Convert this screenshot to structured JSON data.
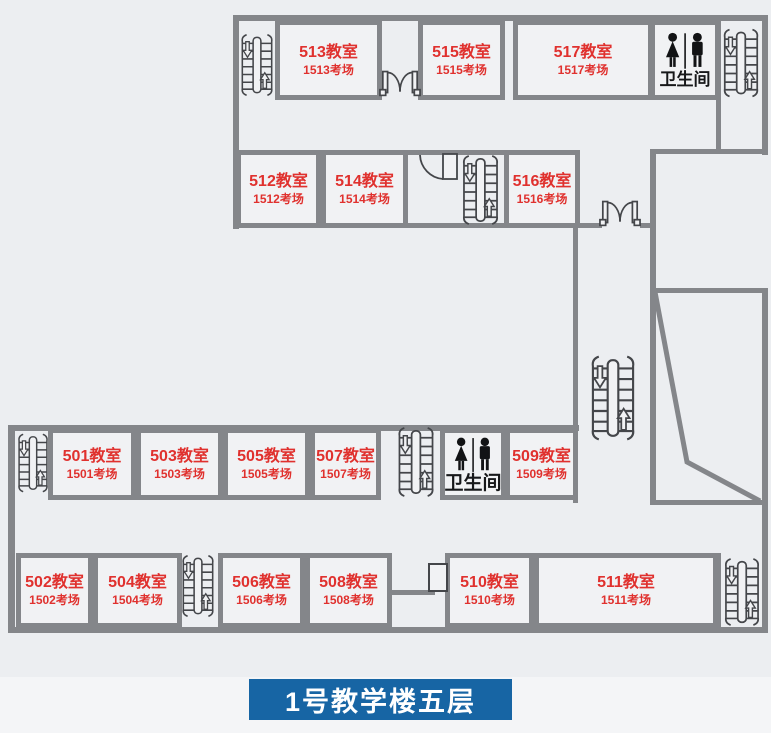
{
  "title": {
    "label": "1号教学楼五层"
  },
  "colors": {
    "wall": "#84868a",
    "room_text": "#e0312e",
    "title_bg": "#1765a4",
    "title_text": "#ffffff",
    "icon": "#17181a",
    "background": "#eceef1"
  },
  "restrooms": [
    {
      "label": "卫生间"
    },
    {
      "label": "卫生间"
    }
  ],
  "rooms": [
    {
      "name": "513教室",
      "exam": "1513考场"
    },
    {
      "name": "515教室",
      "exam": "1515考场"
    },
    {
      "name": "517教室",
      "exam": "1517考场"
    },
    {
      "name": "512教室",
      "exam": "1512考场"
    },
    {
      "name": "514教室",
      "exam": "1514考场"
    },
    {
      "name": "516教室",
      "exam": "1516考场"
    },
    {
      "name": "501教室",
      "exam": "1501考场"
    },
    {
      "name": "503教室",
      "exam": "1503考场"
    },
    {
      "name": "505教室",
      "exam": "1505考场"
    },
    {
      "name": "507教室",
      "exam": "1507考场"
    },
    {
      "name": "509教室",
      "exam": "1509考场"
    },
    {
      "name": "502教室",
      "exam": "1502考场"
    },
    {
      "name": "504教室",
      "exam": "1504考场"
    },
    {
      "name": "506教室",
      "exam": "1506考场"
    },
    {
      "name": "508教室",
      "exam": "1508考场"
    },
    {
      "name": "510教室",
      "exam": "1510考场"
    },
    {
      "name": "511教室",
      "exam": "1511考场"
    }
  ]
}
